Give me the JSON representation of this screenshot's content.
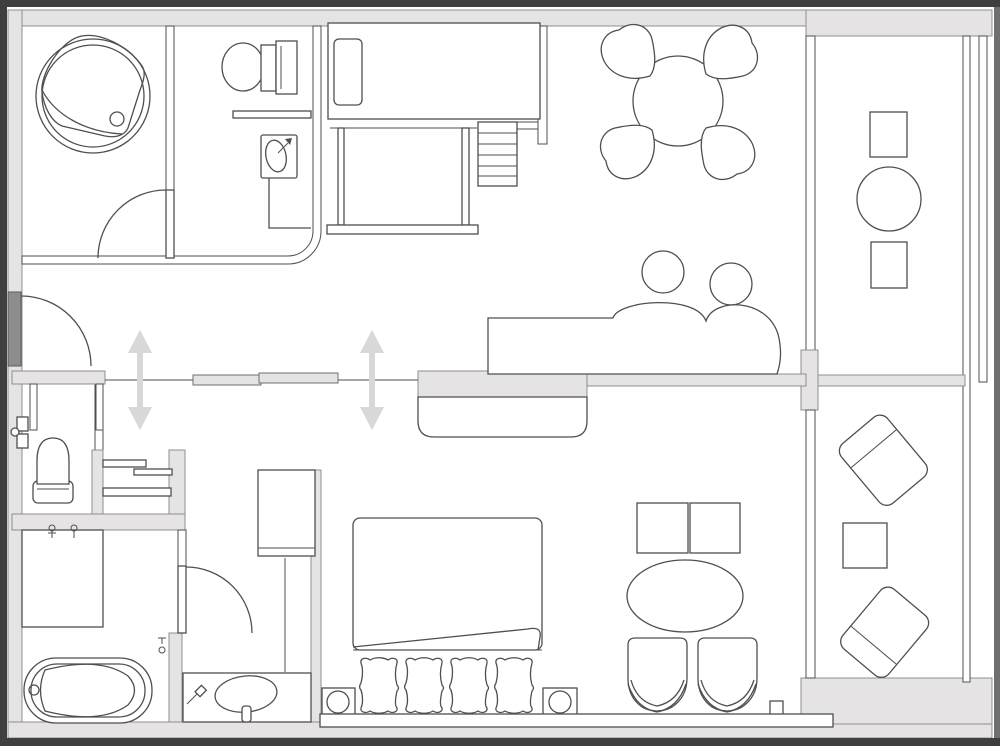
{
  "title": "Hotel suite floor plan",
  "canvas": {
    "width": 1000,
    "height": 746
  },
  "palette": {
    "background": "#ffffff",
    "wall_fill": "#e5e3e3",
    "wall_edge": "#8f8f8f",
    "line": "#4f4f4f",
    "arrow": "#d8d8d8",
    "entry_door": "#8d8d8d",
    "frame": "#3f3f3f"
  },
  "rooms": [
    {
      "id": "spa-room"
    },
    {
      "id": "upper-bathroom"
    },
    {
      "id": "loft-bed-area"
    },
    {
      "id": "dining-area"
    },
    {
      "id": "living-area"
    },
    {
      "id": "upper-balcony"
    },
    {
      "id": "entry"
    },
    {
      "id": "lower-toilet-room"
    },
    {
      "id": "lower-bathroom"
    },
    {
      "id": "vanity-corridor"
    },
    {
      "id": "bedroom"
    },
    {
      "id": "lower-balcony"
    }
  ],
  "furniture_icons": [
    "jacuzzi-icon",
    "spa-door-icon",
    "toilet-icon",
    "washbasin-icon",
    "bath-counter-icon",
    "loft-bed-icon",
    "loft-frame-icon",
    "stairs-icon",
    "dining-table-icon",
    "dining-chair-icon",
    "sofa-icon",
    "sofa-pillow-icon",
    "tv-icon",
    "tv-console-icon",
    "sliding-door-icon",
    "entry-door-icon",
    "entry-console-icon",
    "shelf-unit-icon",
    "wardrobe-icon",
    "door-arc-icon",
    "double-bed-icon",
    "bed-pillow-icon",
    "nightstand-icon",
    "side-table-icon",
    "coffee-table-icon",
    "lounge-chair-icon",
    "balcony-stool-icon",
    "balcony-table-icon",
    "balcony-lounger-icon",
    "bathtub-icon",
    "shower-area-icon",
    "vanity-sink-icon",
    "faucet-icon"
  ],
  "indicators": {
    "sliding_direction_arrows": 2
  }
}
